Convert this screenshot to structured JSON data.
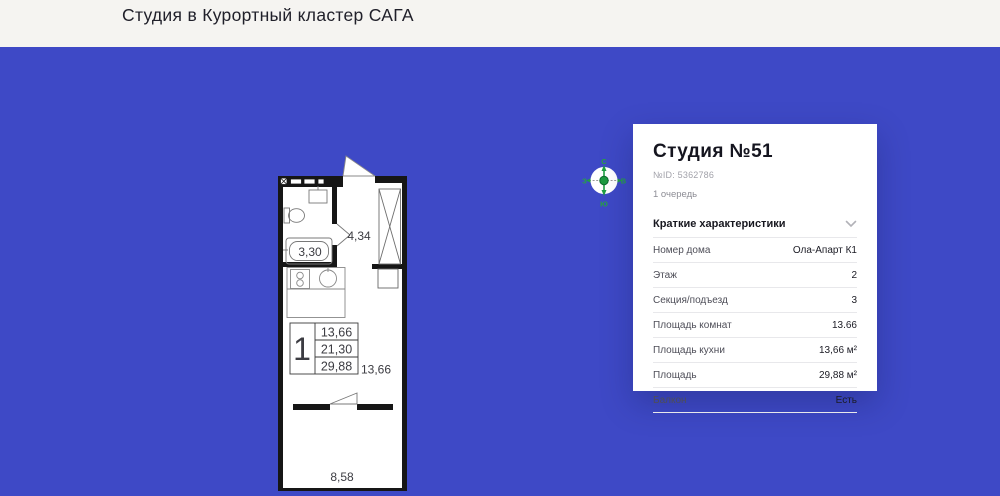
{
  "colors": {
    "background": "#3e49c6",
    "header_bg": "#f5f4f1",
    "card_bg": "#ffffff",
    "wall": "#161616",
    "compass_green": "#1f9e43",
    "text_dark": "#15151f",
    "text_gray": "#a2a2aa"
  },
  "header": {
    "title": "Студия в Курортный кластер САГА"
  },
  "compass": {
    "north": "С",
    "south": "Ю",
    "west": "З",
    "east": "В"
  },
  "floor_plan": {
    "labels": {
      "hallway_area": "4,34",
      "bathroom_area": "3,30",
      "room_area": "13,66",
      "balcony_area": "8,58"
    },
    "stamp": {
      "rooms_count": "1",
      "living_area": "13,66",
      "area_without_balcony": "21,30",
      "total_area": "29,88"
    }
  },
  "card": {
    "title": "Студия №51",
    "id": "№ID: 5362786",
    "queue": "1 очередь",
    "section_title": "Краткие характеристики",
    "chevron_icon": "chevron-down-icon",
    "rows": [
      {
        "label": "Номер дома",
        "value": "Ола-Апарт К1"
      },
      {
        "label": "Этаж",
        "value": "2"
      },
      {
        "label": "Секция/подъезд",
        "value": "3"
      },
      {
        "label": "Площадь комнат",
        "value": "13.66"
      },
      {
        "label": "Площадь кухни",
        "value": "13,66 м²"
      },
      {
        "label": "Площадь",
        "value": "29,88 м²"
      },
      {
        "label": "Балкон",
        "value": "Есть"
      }
    ]
  }
}
